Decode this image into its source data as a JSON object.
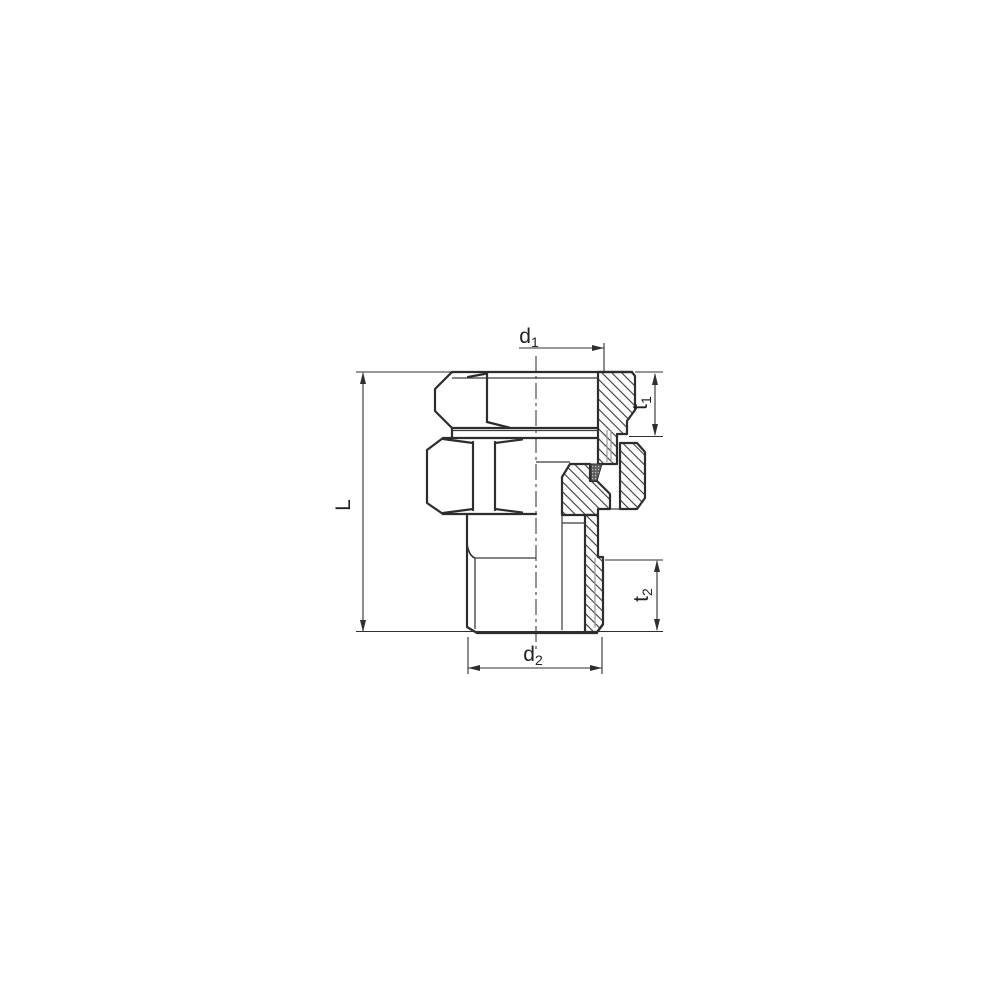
{
  "drawing": {
    "background": "#ffffff",
    "outline_color": "#2d2d2d",
    "hatch_color": "#3a3a3a",
    "thin_gray_color": "#9a9a9a",
    "dims": {
      "d1": {
        "base": "d",
        "sub": "1"
      },
      "t1": {
        "base": "t",
        "sub": "1"
      },
      "t2": {
        "base": "t",
        "sub": "2"
      },
      "d2": {
        "base": "d",
        "sub": "2"
      },
      "L": {
        "base": "L",
        "sub": ""
      }
    }
  }
}
